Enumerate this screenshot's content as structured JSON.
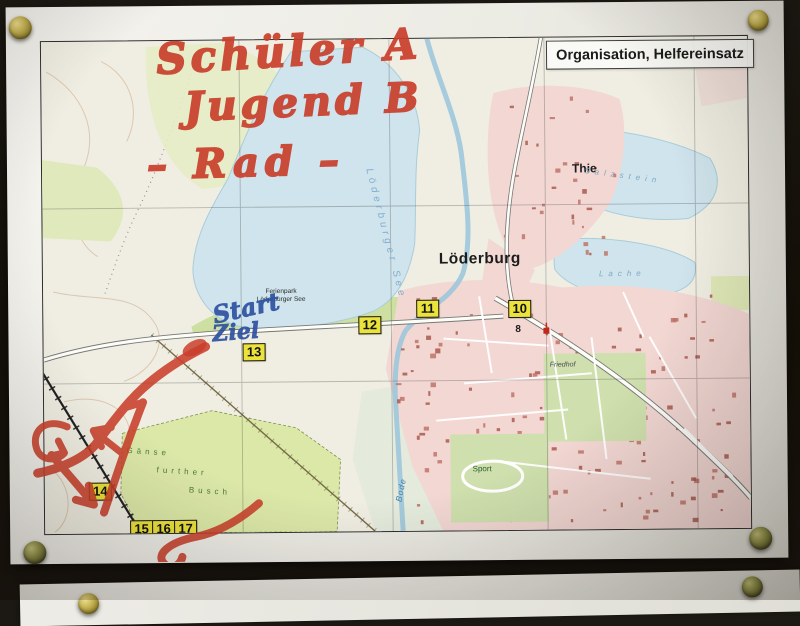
{
  "title_box": {
    "text": "Organisation, Helfereinsatz"
  },
  "handwriting": {
    "red_line1": "Schüler A",
    "red_line2": "Jugend B",
    "red_line3": "– Rad –",
    "blue_start": "Start",
    "blue_ziel": "Ziel"
  },
  "map_labels": {
    "town": "Löderburg",
    "village": "Thie",
    "ferienpark_line1": "Ferienpark",
    "ferienpark_line2": "Löderburger See",
    "lake_main": "Löderburger See",
    "lake_salzstein": "Salzstein",
    "lake_lache": "Lache",
    "river": "Bode",
    "cemetery": "Friedhof",
    "sport": "Sport",
    "forest_line1": "Gänse",
    "forest_line2": "further",
    "forest_line3": "Busch",
    "road_number": "8"
  },
  "checkpoints": [
    {
      "label": "10",
      "x": 465,
      "y": 262
    },
    {
      "label": "11",
      "x": 373,
      "y": 261
    },
    {
      "label": "12",
      "x": 315,
      "y": 277
    },
    {
      "label": "13",
      "x": 199,
      "y": 303
    },
    {
      "label": "14",
      "x": 44,
      "y": 441
    },
    {
      "label": "15",
      "x": 85,
      "y": 479
    },
    {
      "label": "16",
      "x": 107,
      "y": 479
    },
    {
      "label": "17",
      "x": 129,
      "y": 479
    }
  ],
  "colors": {
    "red_marker": "#c93f2b",
    "blue_pen": "#2b4fa0",
    "checkpoint_yellow": "#ece23c",
    "water": "#cfe4ec",
    "forest_green": "#dce8a8",
    "urban_pink": "#f2d7d3",
    "board_dark": "#141109",
    "paper": "#edece6"
  }
}
